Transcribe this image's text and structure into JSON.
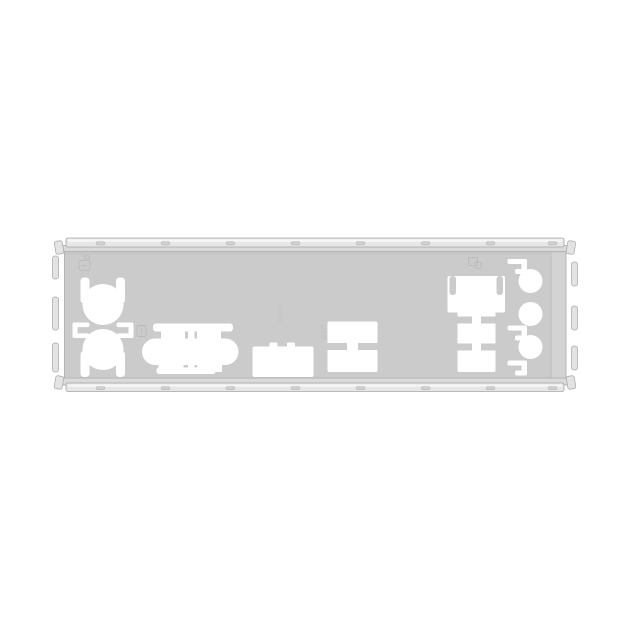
{
  "scene": {
    "description": "Metal motherboard rear I/O shield (back-panel plate) photographed on a plain white background",
    "embossed_labels": {
      "hdmi": "HDMI",
      "usb": "USB"
    }
  },
  "colors": {
    "background": "#ffffff",
    "plate_face": "#cbcbcb",
    "flange": "#e7e7e7",
    "flange_shadow": "#dadada",
    "edge_stroke": "#a6a6a6",
    "inner_stroke": "#b4b4b4",
    "cutout": "#ffffff",
    "highlight": "#f6f6f6",
    "stamp_stroke": "#bcbcbc",
    "emboss_text": "#c2c2c2"
  }
}
